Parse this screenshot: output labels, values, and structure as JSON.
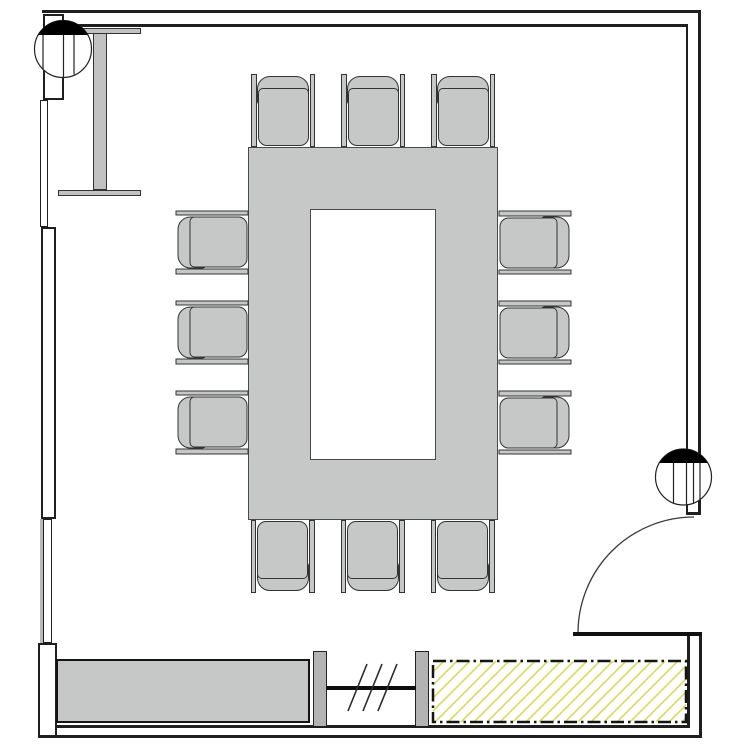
{
  "drawing": {
    "kind": "architectural-floor-plan",
    "room": "conference-room",
    "visible_text": ""
  },
  "colors": {
    "background": "#ffffff",
    "wall_line": "#1f1f1f",
    "furniture_fill": "#c6c7c7",
    "furniture_outline": "#4a4a4a",
    "element_fill": "#c2c2c2",
    "post_fill": "#b3b3b3",
    "glass_line": "#0d0d0d",
    "hatch_line": "#dcdc6a",
    "marker_fill": "#000000"
  },
  "furniture": {
    "conference_table": {
      "shape": "hollow-rectangle"
    },
    "chairs": {
      "count": 12,
      "top": 3,
      "bottom": 3,
      "left": 3,
      "right": 3
    },
    "counter": {
      "count": 1
    },
    "glass_partition": {
      "posts": 2,
      "glazing_tick_marks": 3
    },
    "hatched_zone": {
      "hatch": "diagonal-45",
      "border": "dash-dot"
    }
  },
  "symbols": {
    "section_markers": {
      "count": 2,
      "style": "circle-with-filled-top-segment"
    },
    "door": {
      "type": "single-swing",
      "swing_degrees": 90
    }
  }
}
